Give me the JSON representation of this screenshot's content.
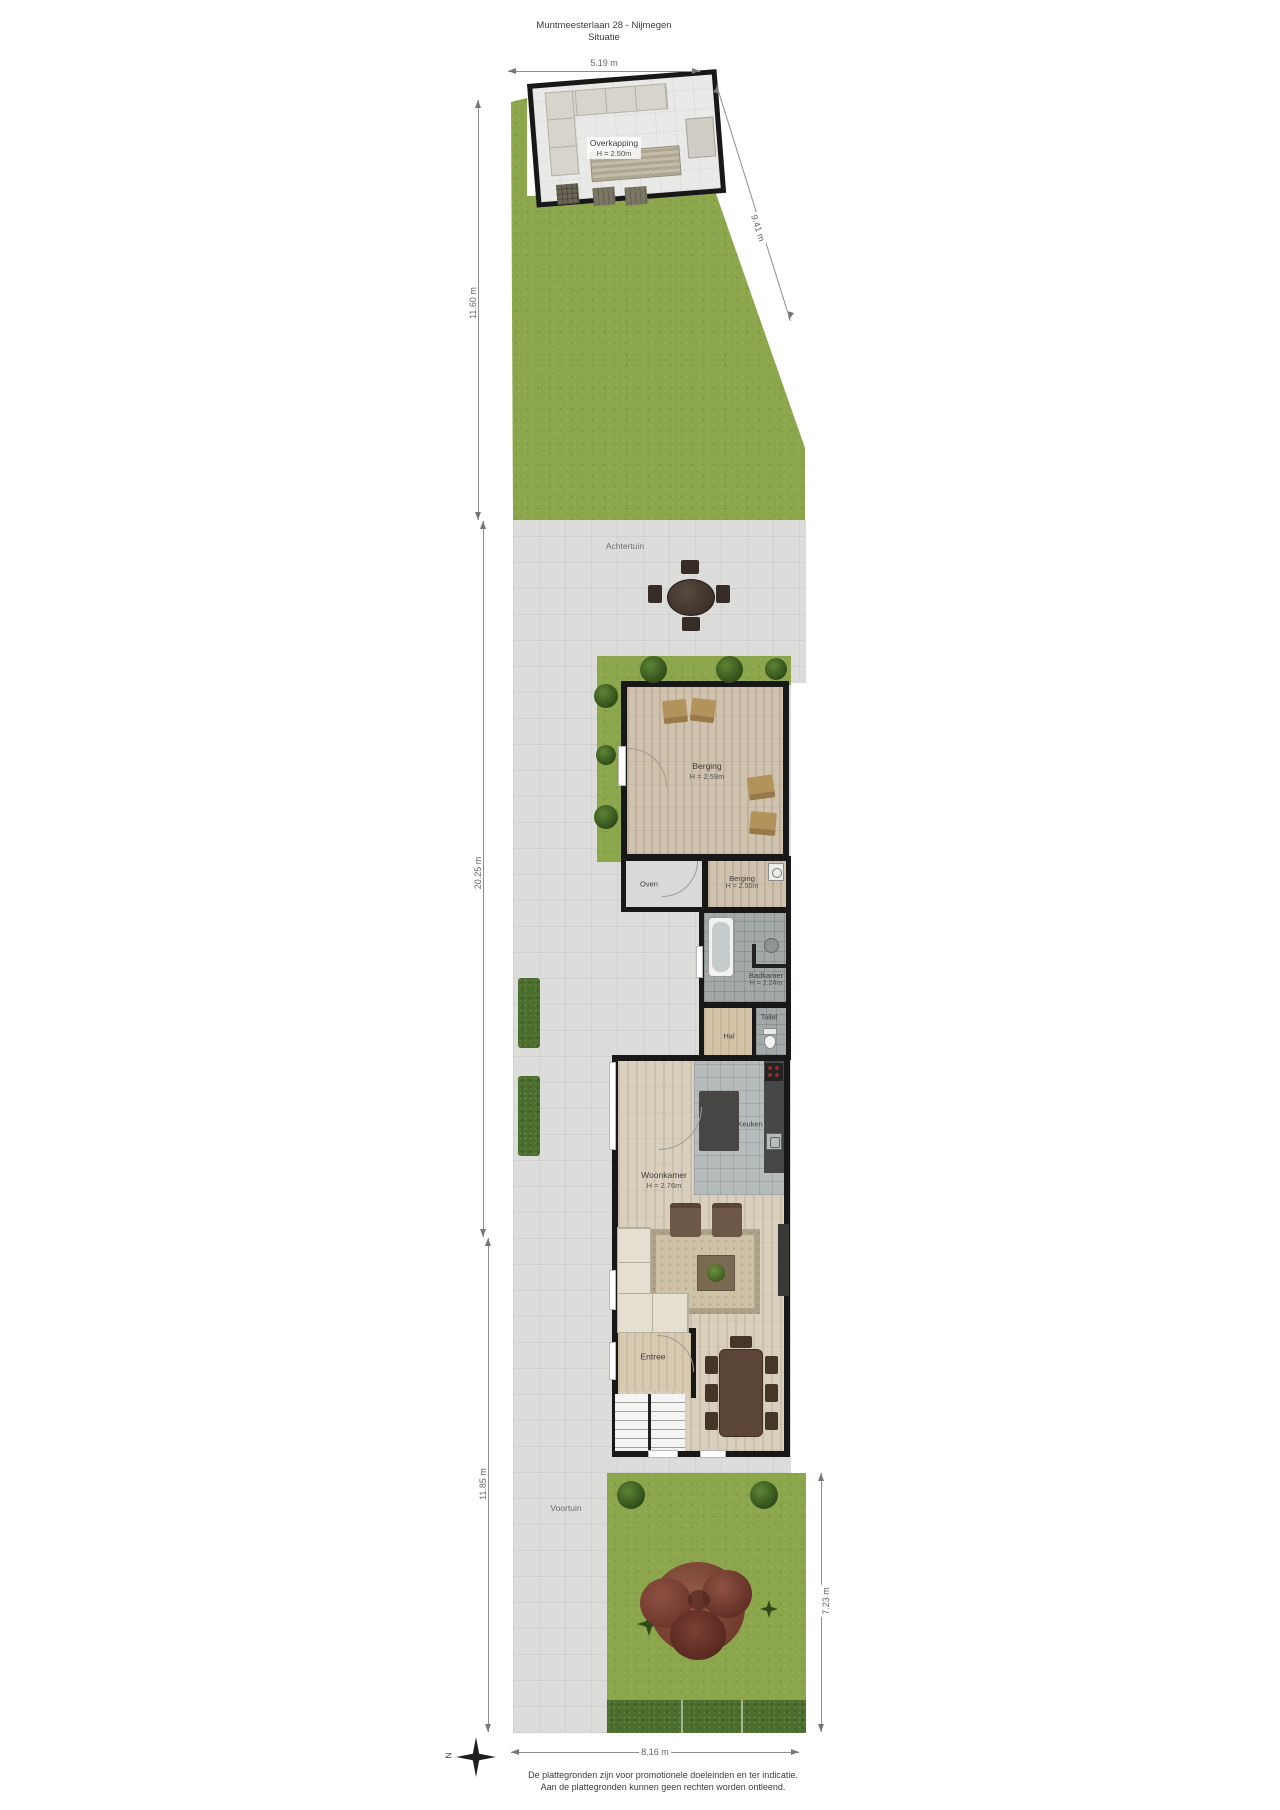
{
  "title": {
    "line1": "Muntmeesterlaan 28 - Nijmegen",
    "line2": "Situatie"
  },
  "outdoor": {
    "back_garden_label": "Achtertuin",
    "front_garden_label": "Voortuin"
  },
  "rooms": {
    "overkapping": {
      "name": "Overkapping",
      "height": "H = 2.50m"
    },
    "shed": {
      "name": "Berging",
      "height": "H = 2.59m"
    },
    "oven": {
      "name": "Oven"
    },
    "storage": {
      "name": "Berging",
      "height": "H = 2.50m"
    },
    "bathroom": {
      "name": "Badkamer",
      "height": "H = 2.24m"
    },
    "hall": {
      "name": "Hal"
    },
    "toilet": {
      "name": "Toilet"
    },
    "kitchen": {
      "name": "Keuken"
    },
    "living_room": {
      "name": "Woonkamer",
      "height": "H = 2.76m"
    },
    "entry": {
      "name": "Entree"
    }
  },
  "dimensions": {
    "top_width": "5.19 m",
    "right_diagonal": "9.41 m",
    "left_upper": "11.60 m",
    "left_middle": "20.25 m",
    "left_lower": "11.85 m",
    "front_garden_depth": "7.23 m",
    "bottom_width": "8.16 m"
  },
  "compass": {
    "north_label": "N"
  },
  "footer": {
    "line1": "De plattegronden zijn voor promotionele doeleinden en ter indicatie.",
    "line2": "Aan de plattegronden kunnen geen rechten worden ontleend."
  },
  "palette": {
    "lawn": "#8ca64b",
    "hedge": "#4b6e2d",
    "pavement": "#dcdcda",
    "wall": "#181818",
    "shed_floor": "#cfc2ae",
    "living_floor": "#d9cfbd",
    "kitchen_tile": "#b6bbbb",
    "bath_tile": "#a3a8a8",
    "autumn_tree": "#7b4034"
  }
}
